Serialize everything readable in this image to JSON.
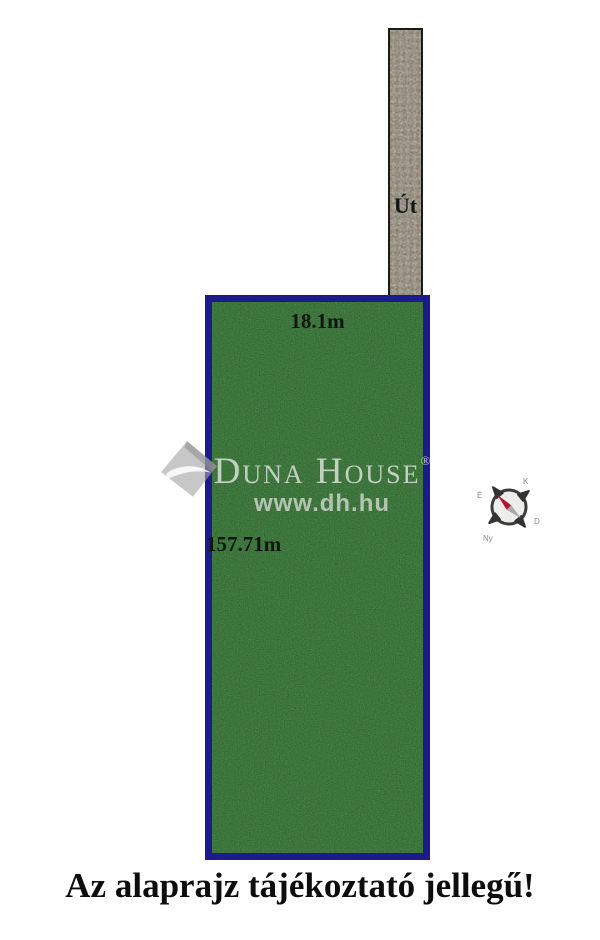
{
  "plot": {
    "top_dimension": "18.1m",
    "left_dimension": "157.71m",
    "fill_color": "#2d7c2b",
    "border_color": "#1b1b8c"
  },
  "road": {
    "label": "Út",
    "fill_color": "#d8d0be"
  },
  "watermark": {
    "brand": "Duna House",
    "registered_mark": "®",
    "website": "www.dh.hu"
  },
  "compass": {
    "north_label": "É",
    "east_label": "K",
    "south_label": "D",
    "west_label": "Ny",
    "needle_color": "#b5122f"
  },
  "disclaimer": "Az alaprajz tájékoztató jellegű!"
}
